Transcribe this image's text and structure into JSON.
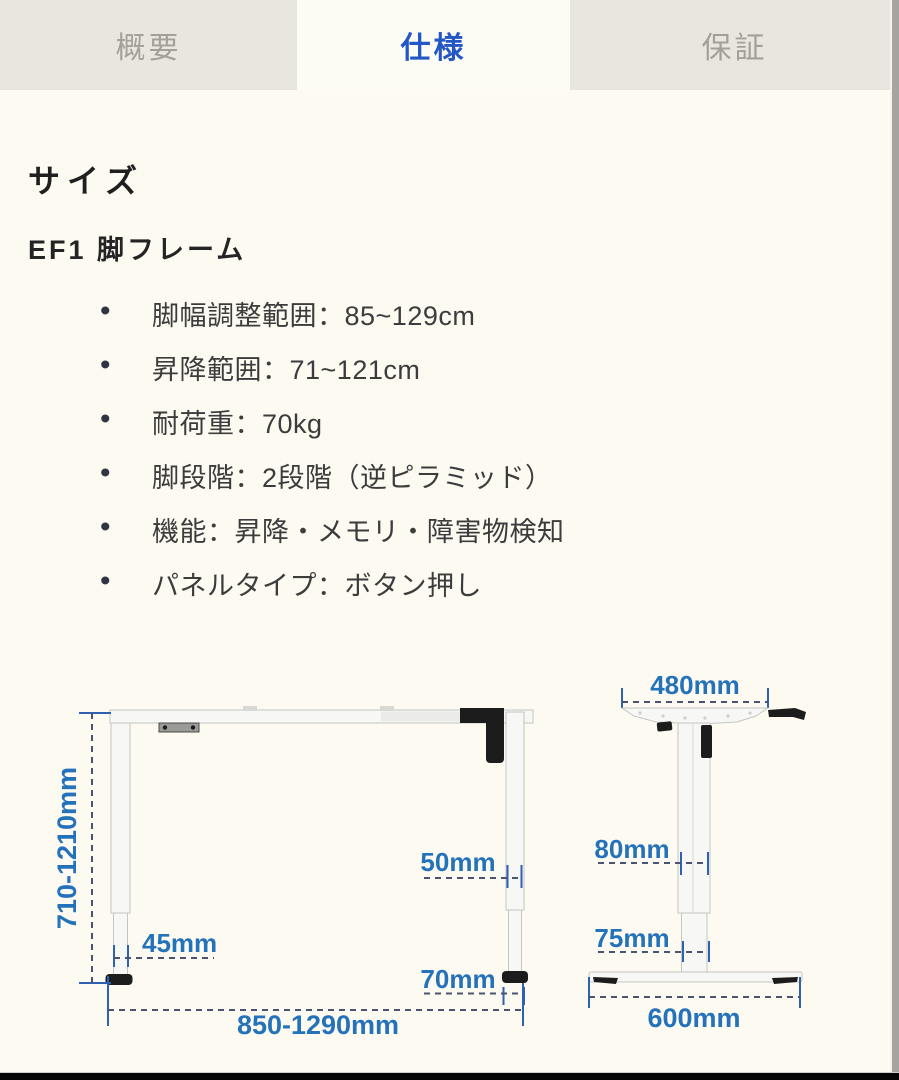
{
  "tabs": [
    {
      "label": "概要",
      "active": false
    },
    {
      "label": "仕様",
      "active": true
    },
    {
      "label": "保証",
      "active": false
    }
  ],
  "content": {
    "section_title": "サイズ",
    "product_title": "EF1 脚フレーム",
    "specs": [
      "脚幅調整範囲：85~129cm",
      "昇降範囲：71~121cm",
      "耐荷重：70kg",
      "脚段階：2段階（逆ピラミッド）",
      "機能：昇降・メモリ・障害物検知",
      "パネルタイプ：ボタン押し"
    ]
  },
  "diagram": {
    "front_view": {
      "height_range": "710-1210mm",
      "lower_leg_width": "45mm",
      "upper_leg_width": "50mm",
      "foot_width": "70mm",
      "frame_width_range": "850-1290mm"
    },
    "side_view": {
      "top_bracket_depth": "480mm",
      "upper_column_depth": "80mm",
      "lower_column_depth": "75mm",
      "foot_depth": "600mm"
    }
  },
  "colors": {
    "page_background": "#fcfaf1",
    "tab_inactive_background": "#e9e6df",
    "tab_inactive_text": "#a3a098",
    "tab_active_text": "#2357c5",
    "body_text": "#3c3c3c",
    "dimension_text": "#2472b9",
    "dimension_dash_line": "#4a5470",
    "dimension_tick_line": "#2e62b0"
  }
}
